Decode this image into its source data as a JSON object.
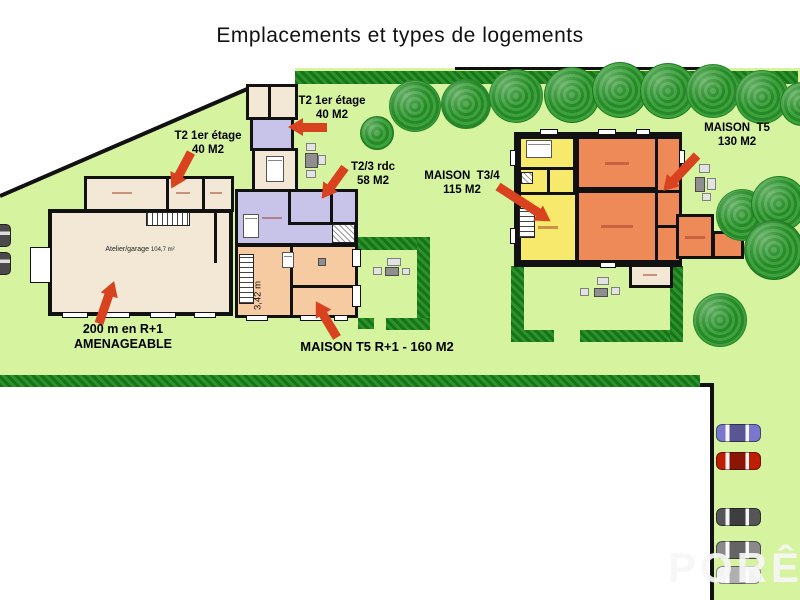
{
  "title": "Emplacements et types de logements",
  "watermark": "PORÊ",
  "annotations": {
    "t2_top": {
      "line1": "T2 1er étage",
      "line2": "40 M2"
    },
    "t2_left": {
      "line1": "T2 1er étage",
      "line2": "40 M2"
    },
    "t23_rdc": {
      "line1": "T2/3 rdc",
      "line2": "58 M2"
    },
    "maison_t34": {
      "line1": "MAISON  T3/4",
      "line2": "115 M2"
    },
    "maison_t5": {
      "line1": "MAISON  T5",
      "line2": "130 M2"
    },
    "maison_t5_r1": {
      "line1": "MAISON T5 R+1 - 160 M2"
    },
    "amenageable": {
      "line1": "200 m en R+1",
      "line2": "AMENAGEABLE"
    }
  },
  "rooms": {
    "atelier_name": "Atelier/garage",
    "atelier_area": "104,7 m²",
    "dim_vertical": "3,42 m"
  },
  "colors": {
    "parcel": "#d6f3a0",
    "hedge": "#1e8c1e",
    "wall": "#111111",
    "cream": "#f2e8d5",
    "lavender": "#c7c3e9",
    "peach": "#f7cba2",
    "yellow": "#f6e96b",
    "orange": "#ee8a58",
    "arrow": "#d8421f"
  },
  "parking": {
    "cars": [
      {
        "color": "#7a78cc",
        "top": 424
      },
      {
        "color": "#c01e04",
        "top": 452
      },
      {
        "color": "#565656",
        "top": 508
      },
      {
        "color": "#8a8a8a",
        "top": 541
      },
      {
        "color": "#f2f2f2",
        "top": 566
      }
    ]
  }
}
